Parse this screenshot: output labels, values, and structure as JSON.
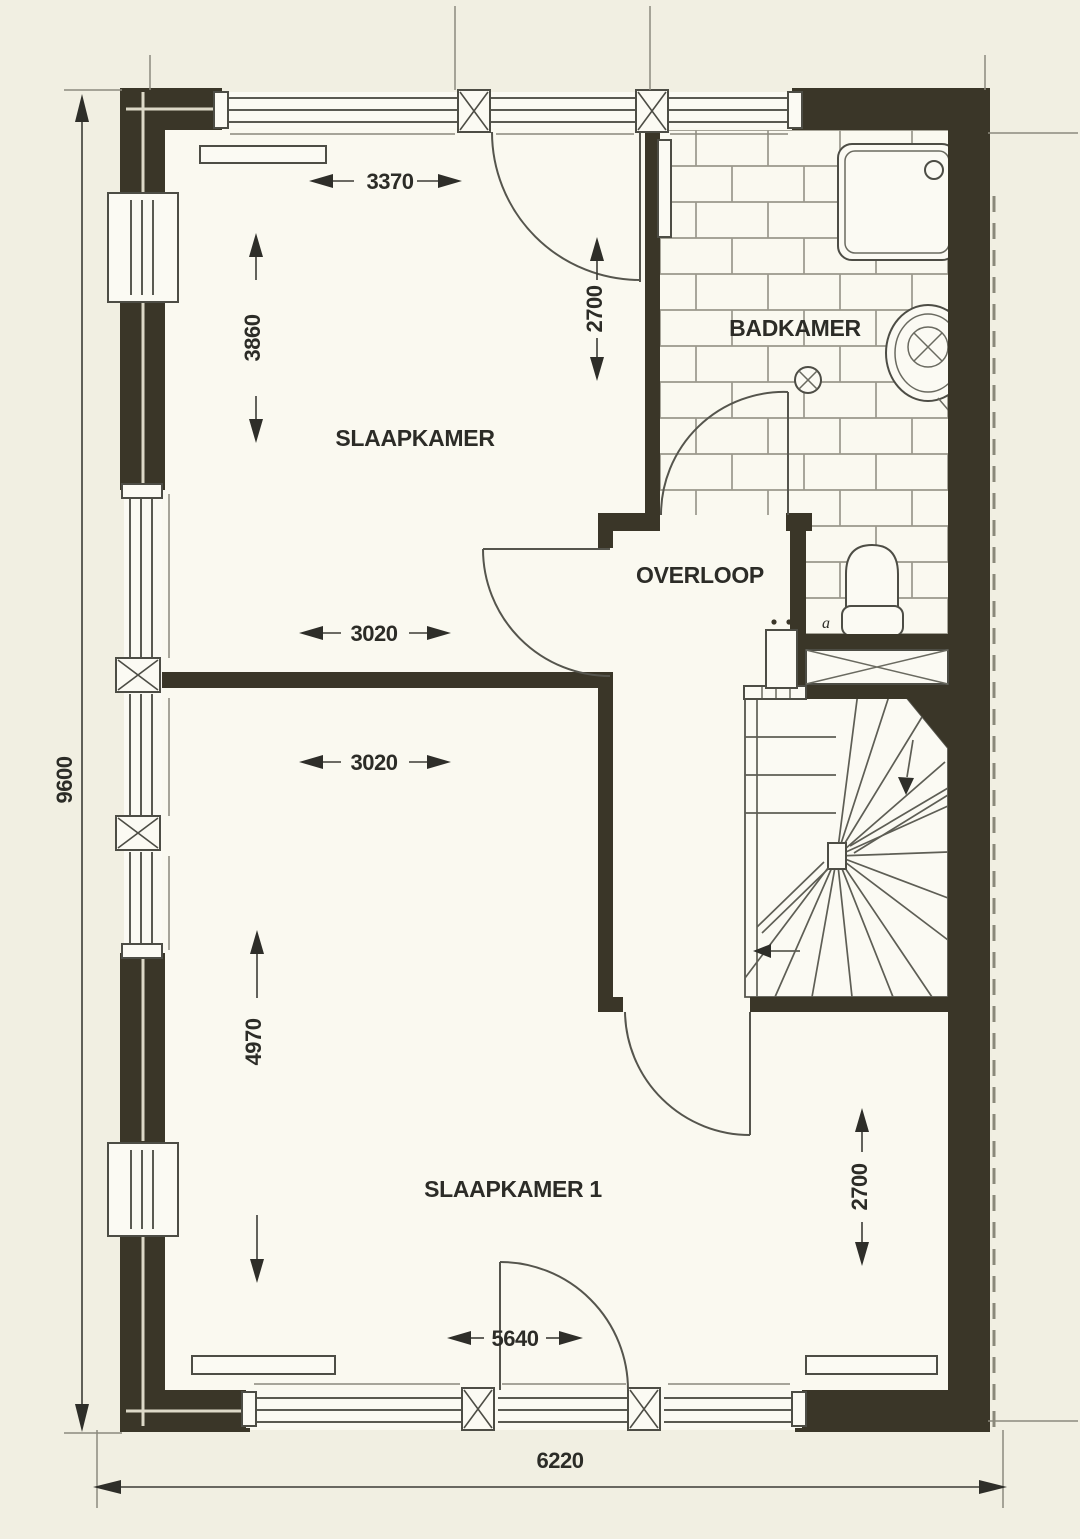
{
  "plan": {
    "rooms": {
      "slaapkamer": {
        "label": "SLAAPKAMER"
      },
      "badkamer": {
        "label": "BADKAMER"
      },
      "overloop": {
        "label": "OVERLOOP"
      },
      "slaapkamer1": {
        "label": "SLAAPKAMER 1"
      }
    },
    "dimensions": {
      "overall_height": "9600",
      "overall_width": "6220",
      "slaapkamer_width": "3370",
      "slaapkamer_depth": "3860",
      "badkamer_depth": "2700",
      "slaapkamer_lower_width": "3020",
      "slaapkamer1_upper_width": "3020",
      "slaapkamer1_depth": "4970",
      "slaapkamer1_right_depth": "2700",
      "slaapkamer1_width": "5640"
    },
    "annotations": {
      "toilet_label": "a"
    },
    "colors": {
      "paper": "#f1efe2",
      "room_fill": "#faf9f0",
      "wall": "#3a3628",
      "line": "#4d4d45",
      "tile_line": "#9a988c",
      "text": "#2c2c27"
    }
  }
}
